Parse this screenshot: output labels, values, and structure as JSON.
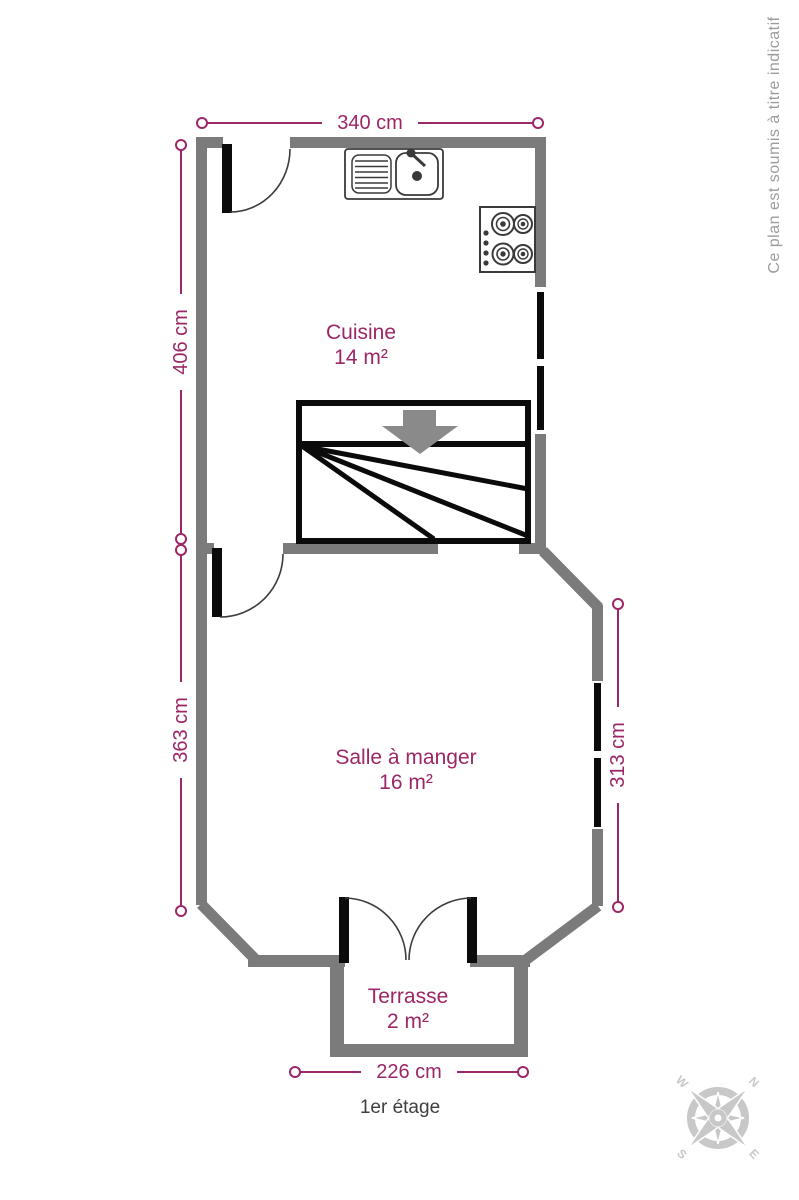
{
  "watermark": "Ce plan est soumis à titre indicatif",
  "floor_label": "1er étage",
  "rooms": {
    "cuisine": {
      "name": "Cuisine",
      "area": "14 m²"
    },
    "salle_a_manger": {
      "name": "Salle à manger",
      "area": "16 m²"
    },
    "terrasse": {
      "name": "Terrasse",
      "area": "2 m²"
    }
  },
  "dimensions": {
    "top": "340 cm",
    "left_upper": "406 cm",
    "left_lower": "363 cm",
    "right": "313 cm",
    "bottom": "226 cm"
  },
  "compass": {
    "north": "N",
    "south": "S",
    "east": "E",
    "west": "W"
  },
  "icons": {
    "sink": "kitchen-sink-icon",
    "stove": "stove-hob-icon",
    "stairs": "staircase-icon",
    "compass": "compass-rose-icon"
  },
  "colors": {
    "dimension_accent": "#9C2766",
    "wall_gray": "#7B7B7B",
    "feature_black": "#0B0B0B",
    "arrow_gray": "#8A8A8A",
    "fixture_gray": "#3A3A3A",
    "floor_label_gray": "#3F3F3F",
    "watermark_gray": "#9C9C9C",
    "compass_gray": "#C8C8C8"
  }
}
